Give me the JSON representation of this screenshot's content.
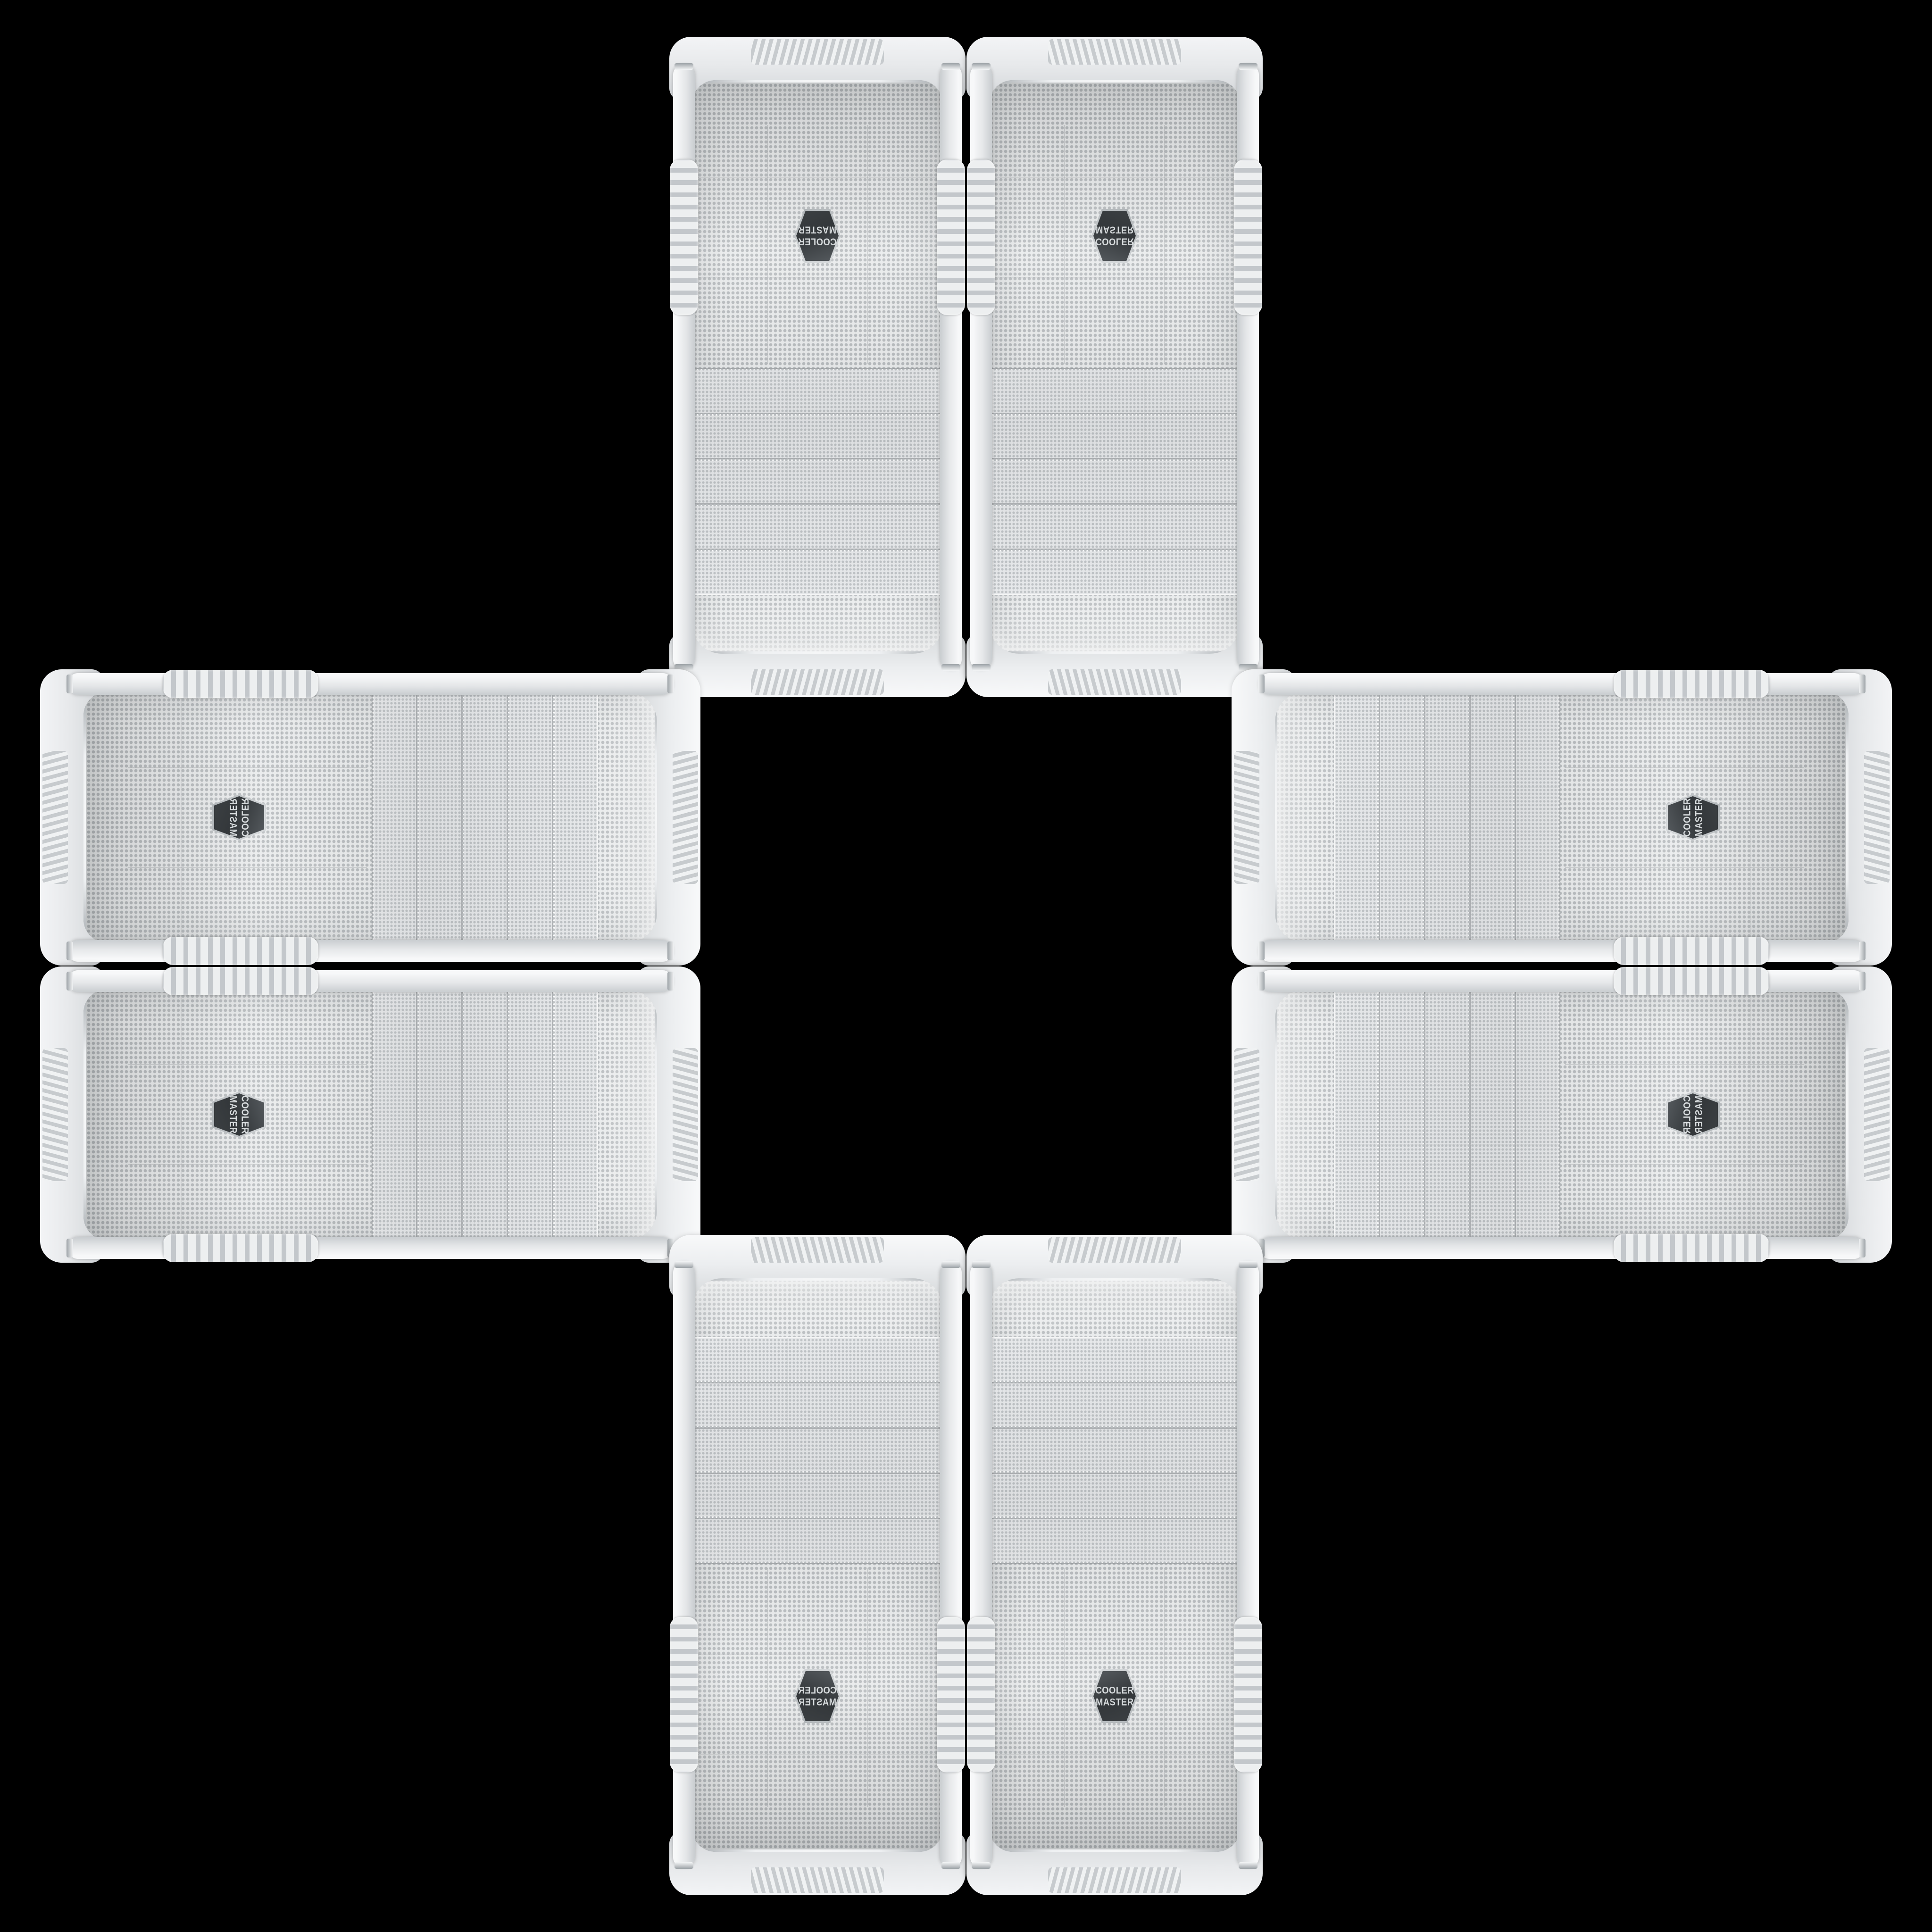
{
  "image": {
    "kind": "product-photo montage",
    "subject": "white Cooler Master PC tower cases arranged in a mirrored cross pattern",
    "background_color": "#000000",
    "case_count": 8
  },
  "badge": {
    "line1": "COOLER",
    "line2": "MASTER"
  },
  "colors": {
    "background": "#000000",
    "case_body": "#eceef0",
    "case_shadowed": "#d2d5d8",
    "mesh_base": "#e8eaeb",
    "mesh_dots": "#b5b9bc",
    "badge_face": "#33373a",
    "badge_rim": "#d9dcde",
    "badge_text": "#d6dadc"
  },
  "cases": [
    {
      "id": "top-left",
      "orientation": "vertical, rotated 180°"
    },
    {
      "id": "top-right",
      "orientation": "vertical, flipped vertically"
    },
    {
      "id": "left-top",
      "orientation": "horizontal, top facing center-right"
    },
    {
      "id": "right-top",
      "orientation": "horizontal, top facing center-left"
    },
    {
      "id": "left-bottom",
      "orientation": "horizontal, top facing center-right"
    },
    {
      "id": "right-bottom",
      "orientation": "horizontal, top facing center-left"
    },
    {
      "id": "bottom-left",
      "orientation": "vertical upright, mirrored"
    },
    {
      "id": "bottom-right",
      "orientation": "vertical upright"
    }
  ]
}
